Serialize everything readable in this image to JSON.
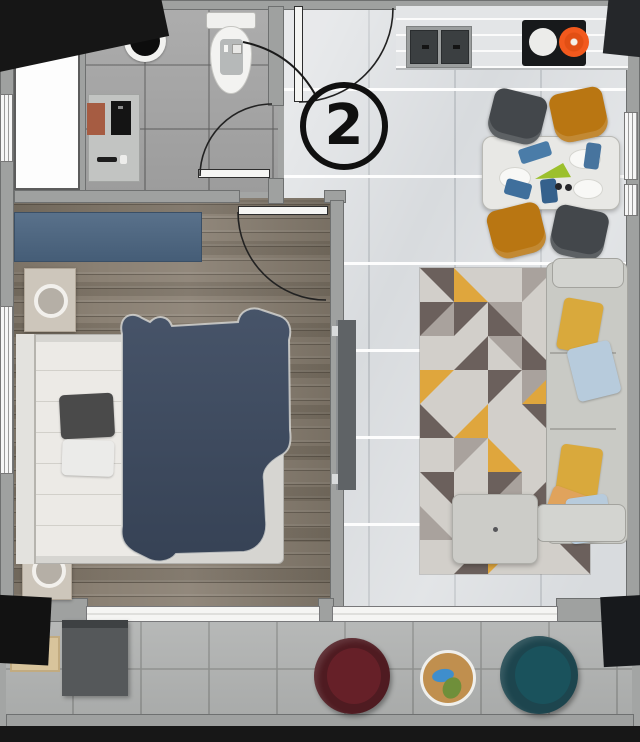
{
  "unit_callout": {
    "label": "2"
  },
  "colors": {
    "wall_gray": "#9fa1a0",
    "corner_marker_black": "#161616",
    "bathroom_floor": "#a6a6a6",
    "kitchen_floor": "#d8dbde",
    "bedroom_wood_floor": "#8b8174",
    "balcony_floor": "#b1b3b2",
    "wardrobe_blue": "#4b6581",
    "duvet_navy": "#3d4a5f",
    "sofa_gray": "#c9cac5",
    "pillow_yellow": "#d9a93c",
    "pillow_blue": "#b7cbdc",
    "pillow_peach": "#e0a35c",
    "dining_chair_dark": "#43474b",
    "dining_chair_orange": "#b97612",
    "cooktop_black": "#17191b",
    "burner_orange": "#f2591d",
    "armchair_maroon": "#4f1b21",
    "armchair_teal": "#1d454e",
    "side_table_tan": "#c08f4e",
    "rug_mustard": "#dfa63d",
    "rug_dark_taupe": "#6b605c"
  },
  "rug": {
    "cols": 5,
    "rows": 9,
    "palette": [
      "#d2cfca",
      "#a9a29d",
      "#6b605c",
      "#dfa63d",
      "#c2bcb6"
    ],
    "tiles": [
      [
        2,
        0,
        "bl"
      ],
      [
        3,
        0,
        "tr"
      ],
      [
        0,
        0,
        "s"
      ],
      [
        1,
        0,
        "br"
      ],
      [
        0,
        0,
        "s"
      ],
      [
        1,
        2,
        "tl"
      ],
      [
        2,
        0,
        "br"
      ],
      [
        2,
        1,
        "tr"
      ],
      [
        0,
        0,
        "s"
      ],
      [
        3,
        0,
        "bl"
      ],
      [
        0,
        0,
        "s"
      ],
      [
        2,
        0,
        "tl"
      ],
      [
        1,
        0,
        "bl"
      ],
      [
        2,
        0,
        "tr"
      ],
      [
        4,
        0,
        "br"
      ],
      [
        3,
        0,
        "br"
      ],
      [
        0,
        0,
        "s"
      ],
      [
        2,
        0,
        "br"
      ],
      [
        3,
        1,
        "tl"
      ],
      [
        1,
        0,
        "bl"
      ],
      [
        2,
        0,
        "tr"
      ],
      [
        3,
        0,
        "tl"
      ],
      [
        0,
        0,
        "s"
      ],
      [
        2,
        0,
        "bl"
      ],
      [
        2,
        1,
        "br"
      ],
      [
        0,
        0,
        "s"
      ],
      [
        1,
        0,
        "br"
      ],
      [
        3,
        0,
        "tr"
      ],
      [
        0,
        0,
        "s"
      ],
      [
        3,
        0,
        "tl"
      ],
      [
        2,
        0,
        "bl"
      ],
      [
        0,
        0,
        "s"
      ],
      [
        2,
        1,
        "br"
      ],
      [
        2,
        0,
        "tl"
      ],
      [
        0,
        0,
        "s"
      ],
      [
        1,
        0,
        "tr"
      ],
      [
        3,
        0,
        "bl"
      ],
      [
        0,
        0,
        "s"
      ],
      [
        1,
        0,
        "br"
      ],
      [
        2,
        0,
        "tr"
      ],
      [
        0,
        0,
        "s"
      ],
      [
        2,
        0,
        "tl"
      ],
      [
        3,
        0,
        "br"
      ],
      [
        0,
        0,
        "s"
      ],
      [
        2,
        0,
        "bl"
      ]
    ]
  }
}
